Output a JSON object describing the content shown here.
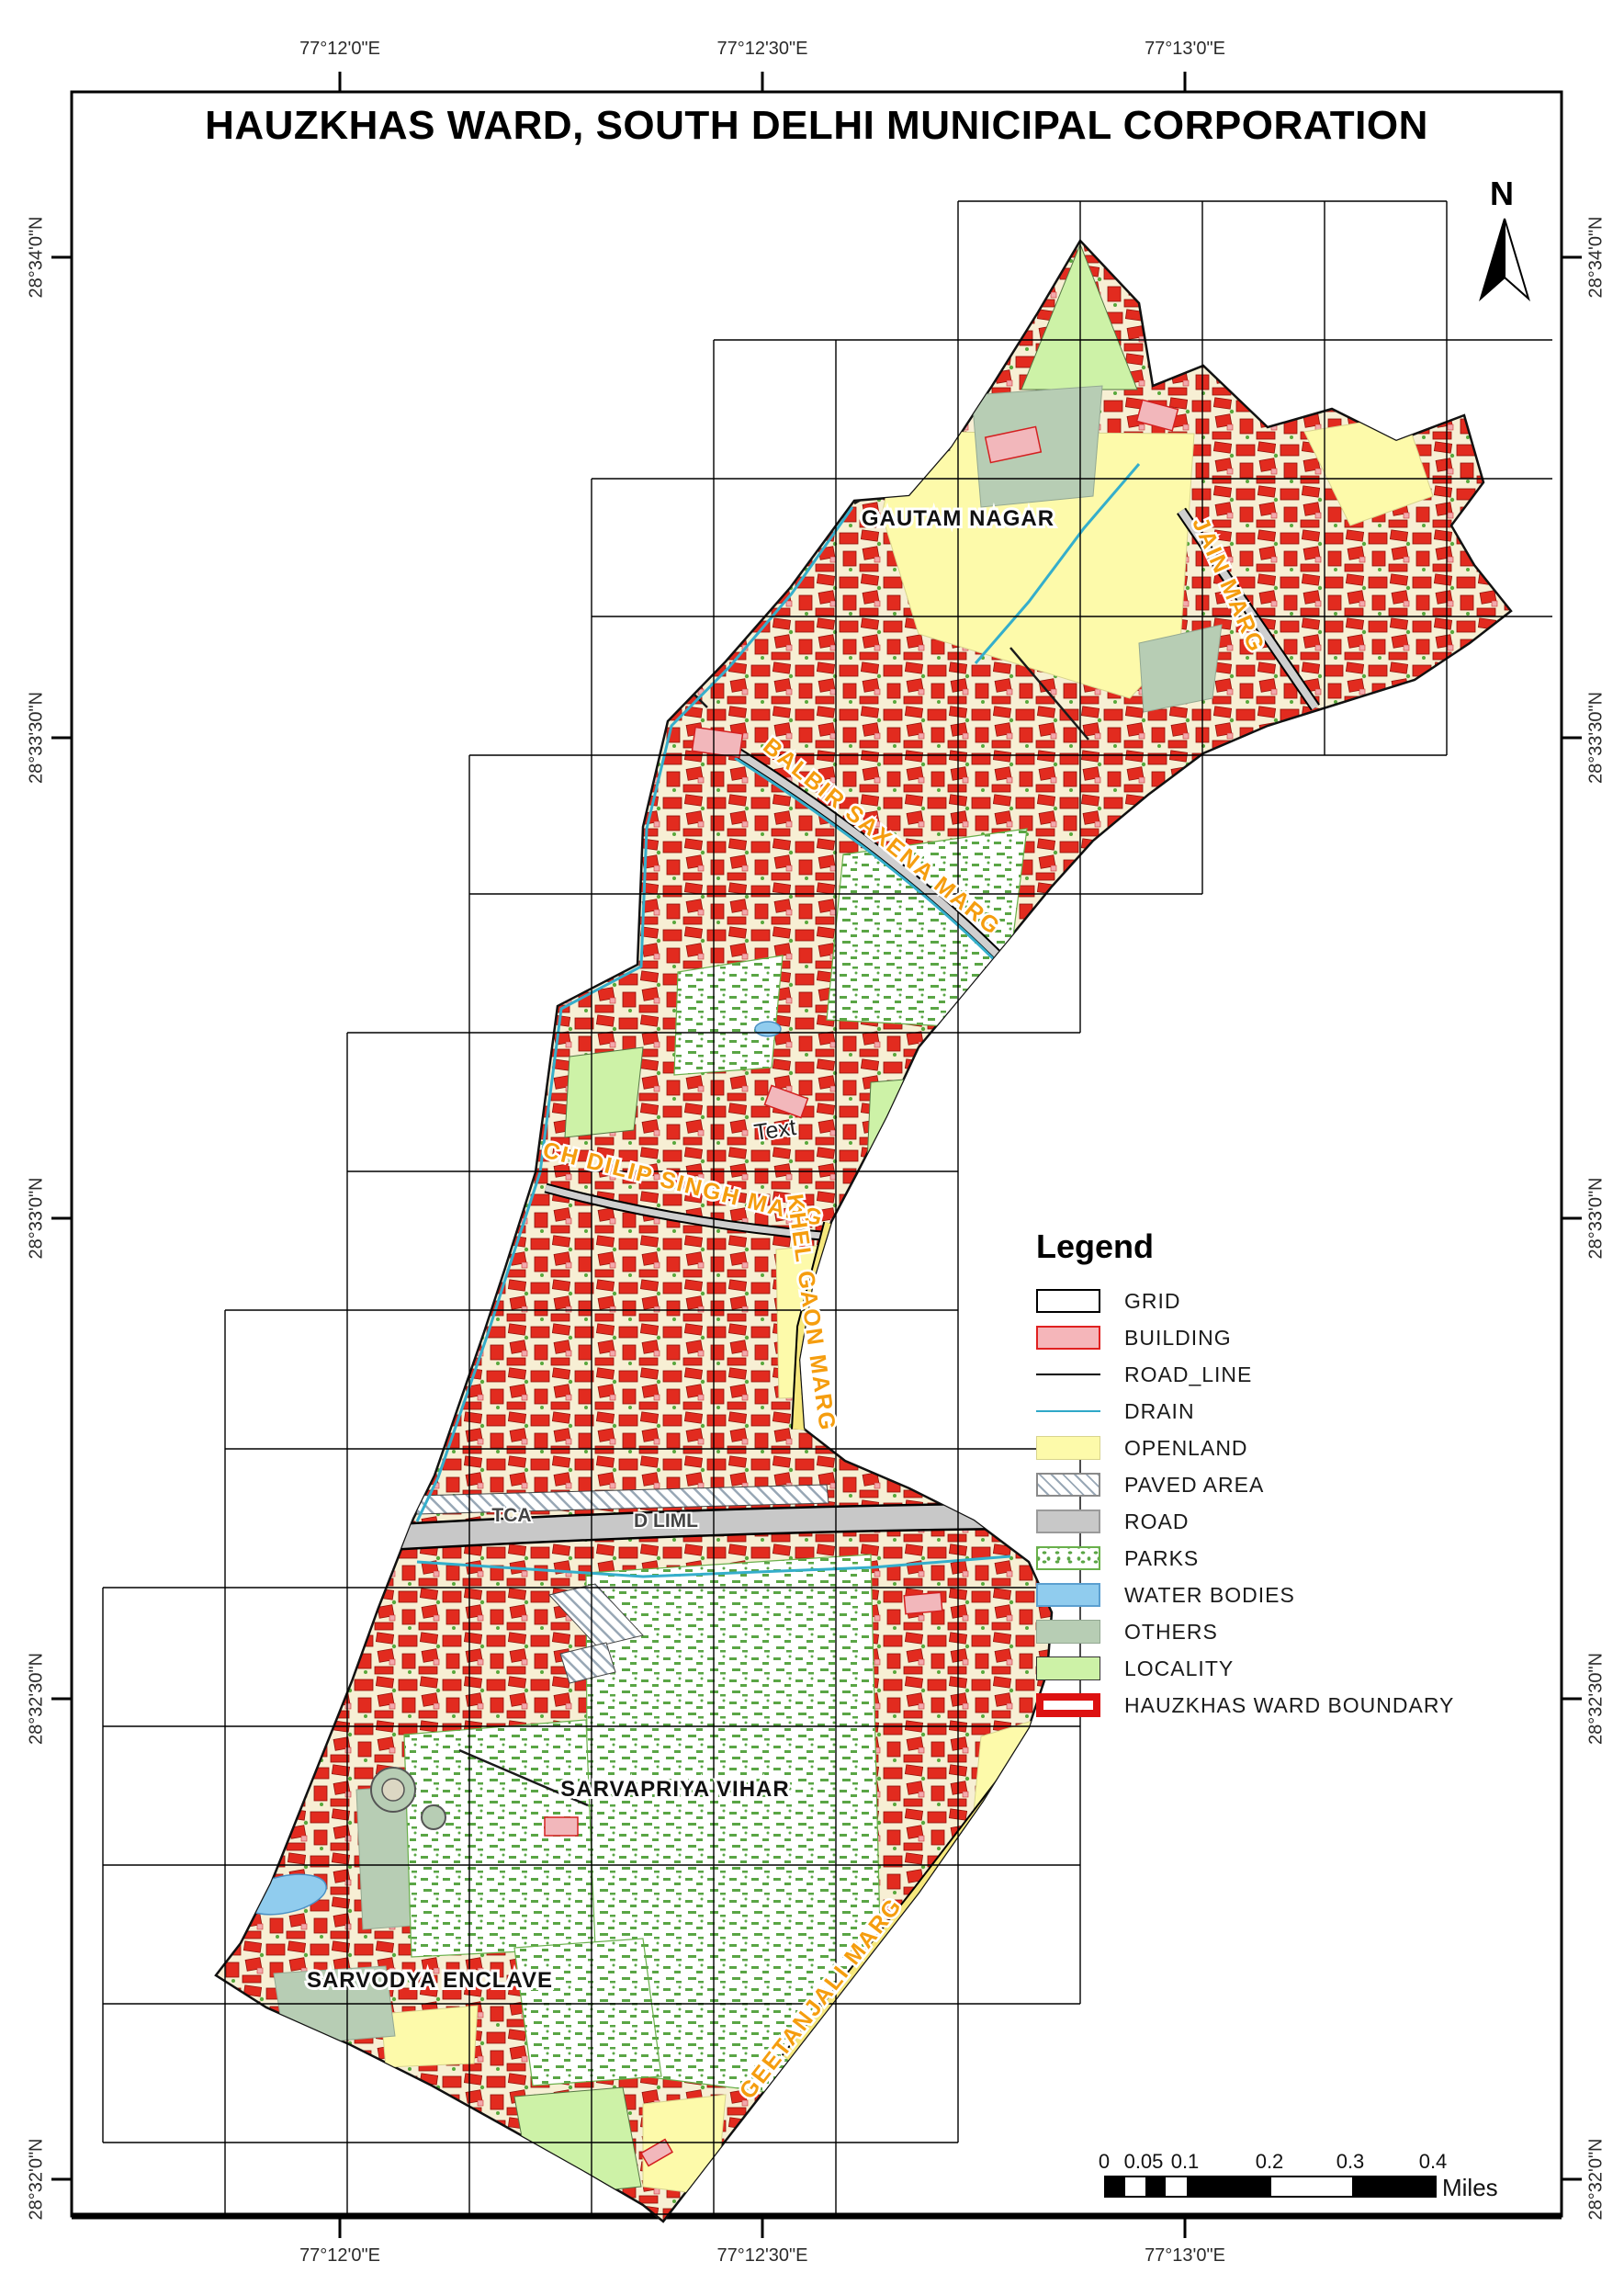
{
  "title": "HAUZKHAS WARD, SOUTH DELHI MUNICIPAL CORPORATION",
  "north_arrow": {
    "label": "N"
  },
  "axes": {
    "top": [
      "77°12'0\"E",
      "77°12'30\"E",
      "77°13'0\"E"
    ],
    "bottom": [
      "77°12'0\"E",
      "77°12'30\"E",
      "77°13'0\"E"
    ],
    "left": [
      "28°34'0\"N",
      "28°33'30\"N",
      "28°33'0\"N",
      "28°32'30\"N",
      "28°32'0\"N"
    ],
    "right": [
      "28°34'0\"N",
      "28°33'30\"N",
      "28°33'0\"N",
      "28°32'30\"N",
      "28°32'0\"N"
    ]
  },
  "legend": {
    "title": "Legend",
    "items": [
      {
        "key": "grid",
        "label": "GRID"
      },
      {
        "key": "building",
        "label": "BUILDING"
      },
      {
        "key": "road_line",
        "label": "ROAD_LINE"
      },
      {
        "key": "drain",
        "label": "DRAIN"
      },
      {
        "key": "openland",
        "label": "OPENLAND"
      },
      {
        "key": "paved_area",
        "label": "PAVED AREA"
      },
      {
        "key": "road",
        "label": "ROAD"
      },
      {
        "key": "parks",
        "label": "PARKS"
      },
      {
        "key": "water_bodies",
        "label": "WATER BODIES"
      },
      {
        "key": "others",
        "label": "OTHERS"
      },
      {
        "key": "locality",
        "label": "LOCALITY"
      },
      {
        "key": "ward_boundary",
        "label": "HAUZKHAS WARD BOUNDARY"
      }
    ]
  },
  "scale_bar": {
    "tick_labels": [
      "0",
      "0.05",
      "0.1",
      "0.2",
      "0.3",
      "0.4"
    ],
    "unit": "Miles"
  },
  "map_labels": {
    "localities": [
      {
        "text": "GAUTAM NAGAR"
      },
      {
        "text": "SARVAPRIYA VIHAR"
      },
      {
        "text": "SARVODYA ENCLAVE"
      }
    ],
    "roads": [
      {
        "text": "JAIN MARG"
      },
      {
        "text": "BALBIR SAXENA MARG"
      },
      {
        "text": "CH DILIP SINGH MARG"
      },
      {
        "text": "KHEL GAON MARG"
      },
      {
        "text": "GEETANJALI MARG"
      }
    ],
    "other": [
      {
        "text": "Text"
      },
      {
        "text": "TCA"
      },
      {
        "text": "D LIML"
      }
    ]
  },
  "colors": {
    "building_fill": "#f5b6ba",
    "building_edge": "#e02020",
    "building_dense": "#e22b1f",
    "road_line": "#000000",
    "drain": "#2fa8c8",
    "openland": "#fdfaaa",
    "road": "#c8c8c8",
    "parks_green": "#5aa545",
    "water": "#90ccee",
    "others": "#b7cdb4",
    "locality": "#cdf2a7",
    "ward_boundary_legend": "#dd1111",
    "road_label": "#f59d0e"
  }
}
